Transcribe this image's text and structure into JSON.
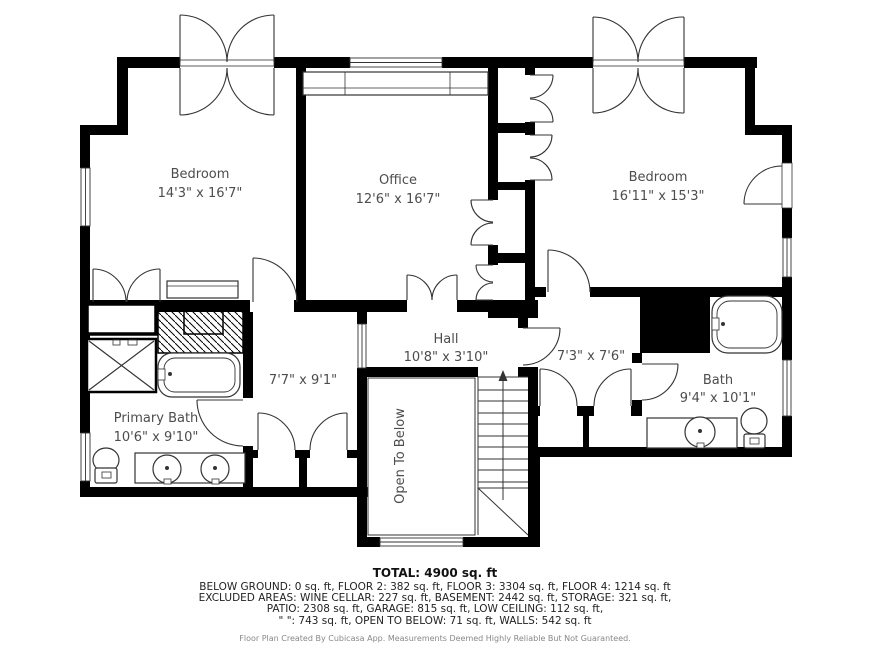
{
  "rooms": [
    {
      "name": "Bedroom",
      "dims": "14'3\" x 16'7\""
    },
    {
      "name": "Office",
      "dims": "12'6\" x 16'7\""
    },
    {
      "name": "Bedroom",
      "dims": "16'11\" x 15'3\""
    },
    {
      "name": "Hall",
      "dims": "10'8\" x 3'10\""
    },
    {
      "name": "",
      "dims": "7'3\" x 7'6\""
    },
    {
      "name": "",
      "dims": "7'7\" x 9'1\""
    },
    {
      "name": "Primary Bath",
      "dims": "10'6\" x 9'10\""
    },
    {
      "name": "Bath",
      "dims": "9'4\" x 10'1\""
    }
  ],
  "annotations": {
    "open_to_below": "Open To Below"
  },
  "summary": {
    "total": "TOTAL: 4900 sq. ft",
    "line1": "BELOW GROUND: 0 sq. ft, FLOOR 2: 382 sq. ft, FLOOR 3: 3304 sq. ft, FLOOR 4: 1214 sq. ft",
    "line2": "EXCLUDED AREAS: WINE CELLAR: 227 sq. ft, BASEMENT: 2442 sq. ft, STORAGE: 321 sq. ft,",
    "line3": "PATIO: 2308 sq. ft, GARAGE: 815 sq. ft, LOW CEILING: 112 sq. ft,",
    "line4": "\" \": 743 sq. ft, OPEN TO BELOW: 71 sq. ft, WALLS: 542 sq. ft"
  },
  "footer": "Floor Plan Created By Cubicasa App. Measurements Deemed Highly Reliable But Not Guaranteed.",
  "colors": {
    "wall": "#000000",
    "symbol": "#333333",
    "label": "#4d4d4d",
    "background": "#ffffff"
  }
}
